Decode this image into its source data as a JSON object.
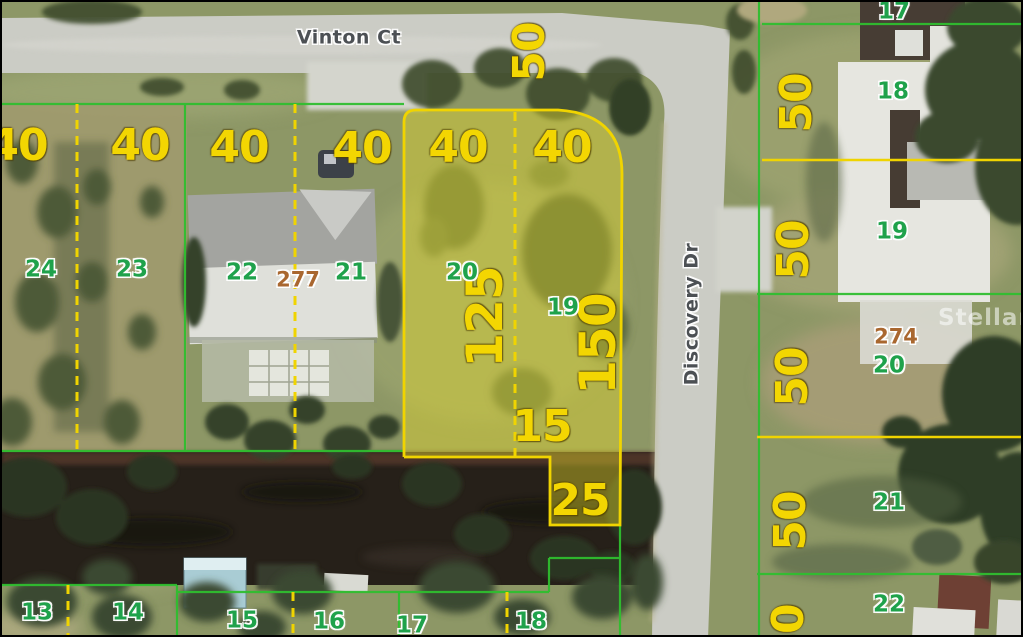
{
  "streets": {
    "horizontal": "Vinton Ct",
    "vertical": "Discovery Dr"
  },
  "watermark": "StellarMLS",
  "dimension_labels": [
    "40",
    "40",
    "40",
    "40",
    "40",
    "40",
    "50",
    "50",
    "50",
    "50",
    "50",
    "50",
    "125",
    "150",
    "15",
    "25"
  ],
  "parcel_numbers": [
    "24",
    "23",
    "22",
    "21",
    "20",
    "19",
    "17",
    "18",
    "19",
    "20",
    "21",
    "22",
    "13",
    "14",
    "15",
    "16",
    "17",
    "18"
  ],
  "block_numbers": [
    "277",
    "274"
  ],
  "colors": {
    "lot_line_green": "#2fbe2f",
    "lot_line_yellow": "#f0d400",
    "dimension_text_yellow": "#f3d602",
    "parcel_number_green": "#1fa24b",
    "block_number_brown": "#a9672f",
    "street_label_gray": "#4c5054",
    "highlight_fill": "rgba(228,217,40,0.42)"
  }
}
